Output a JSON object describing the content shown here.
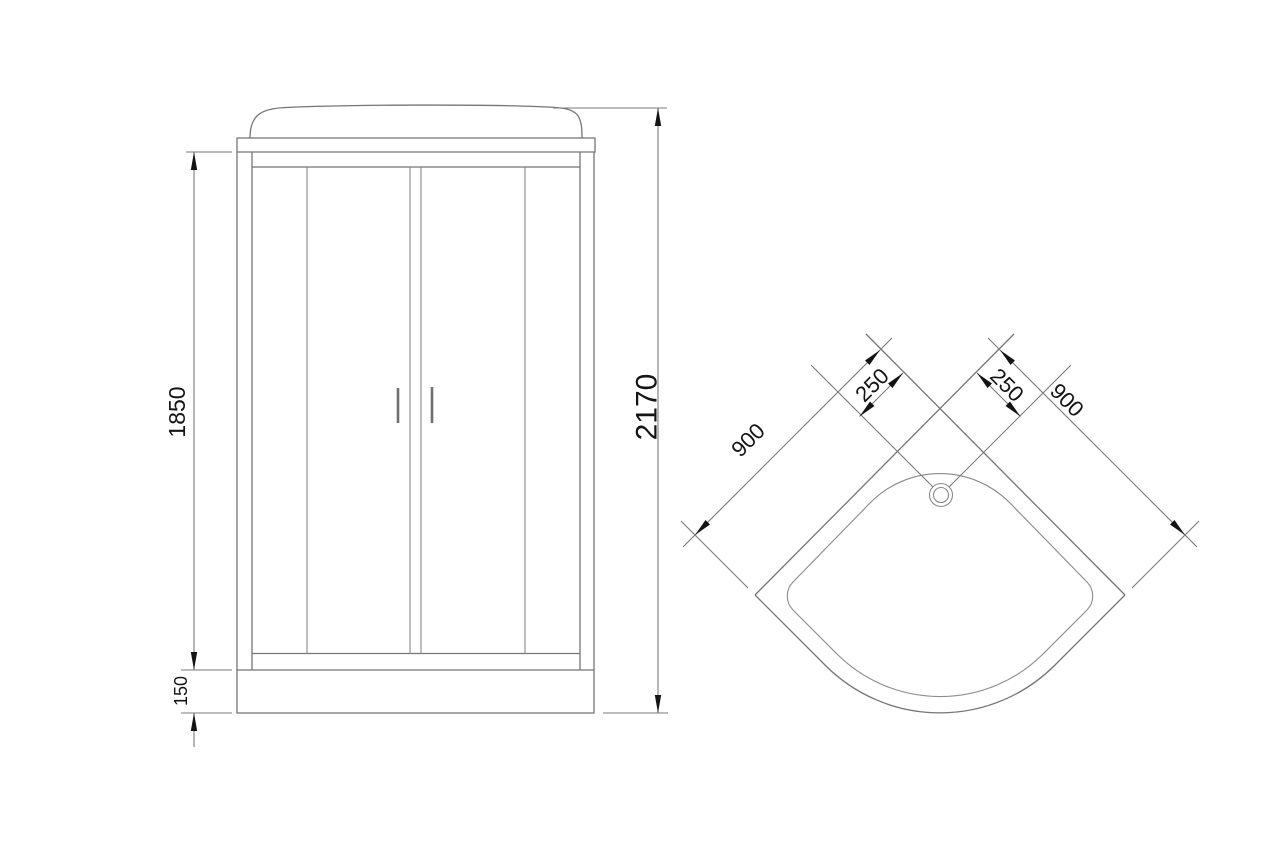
{
  "style": {
    "background": "#ffffff",
    "line_color": "#757575",
    "dimension_line_color": "#7a7a7a",
    "text_color": "#141414",
    "arrow_color": "#141414"
  },
  "front_view": {
    "dimensions": {
      "glass_section_height": "1850",
      "tray_base_height": "150",
      "total_height": "2170"
    }
  },
  "top_view": {
    "dimensions": {
      "left_wall": "900",
      "right_wall": "900",
      "drain_offset_left": "250",
      "drain_offset_right": "250"
    }
  }
}
